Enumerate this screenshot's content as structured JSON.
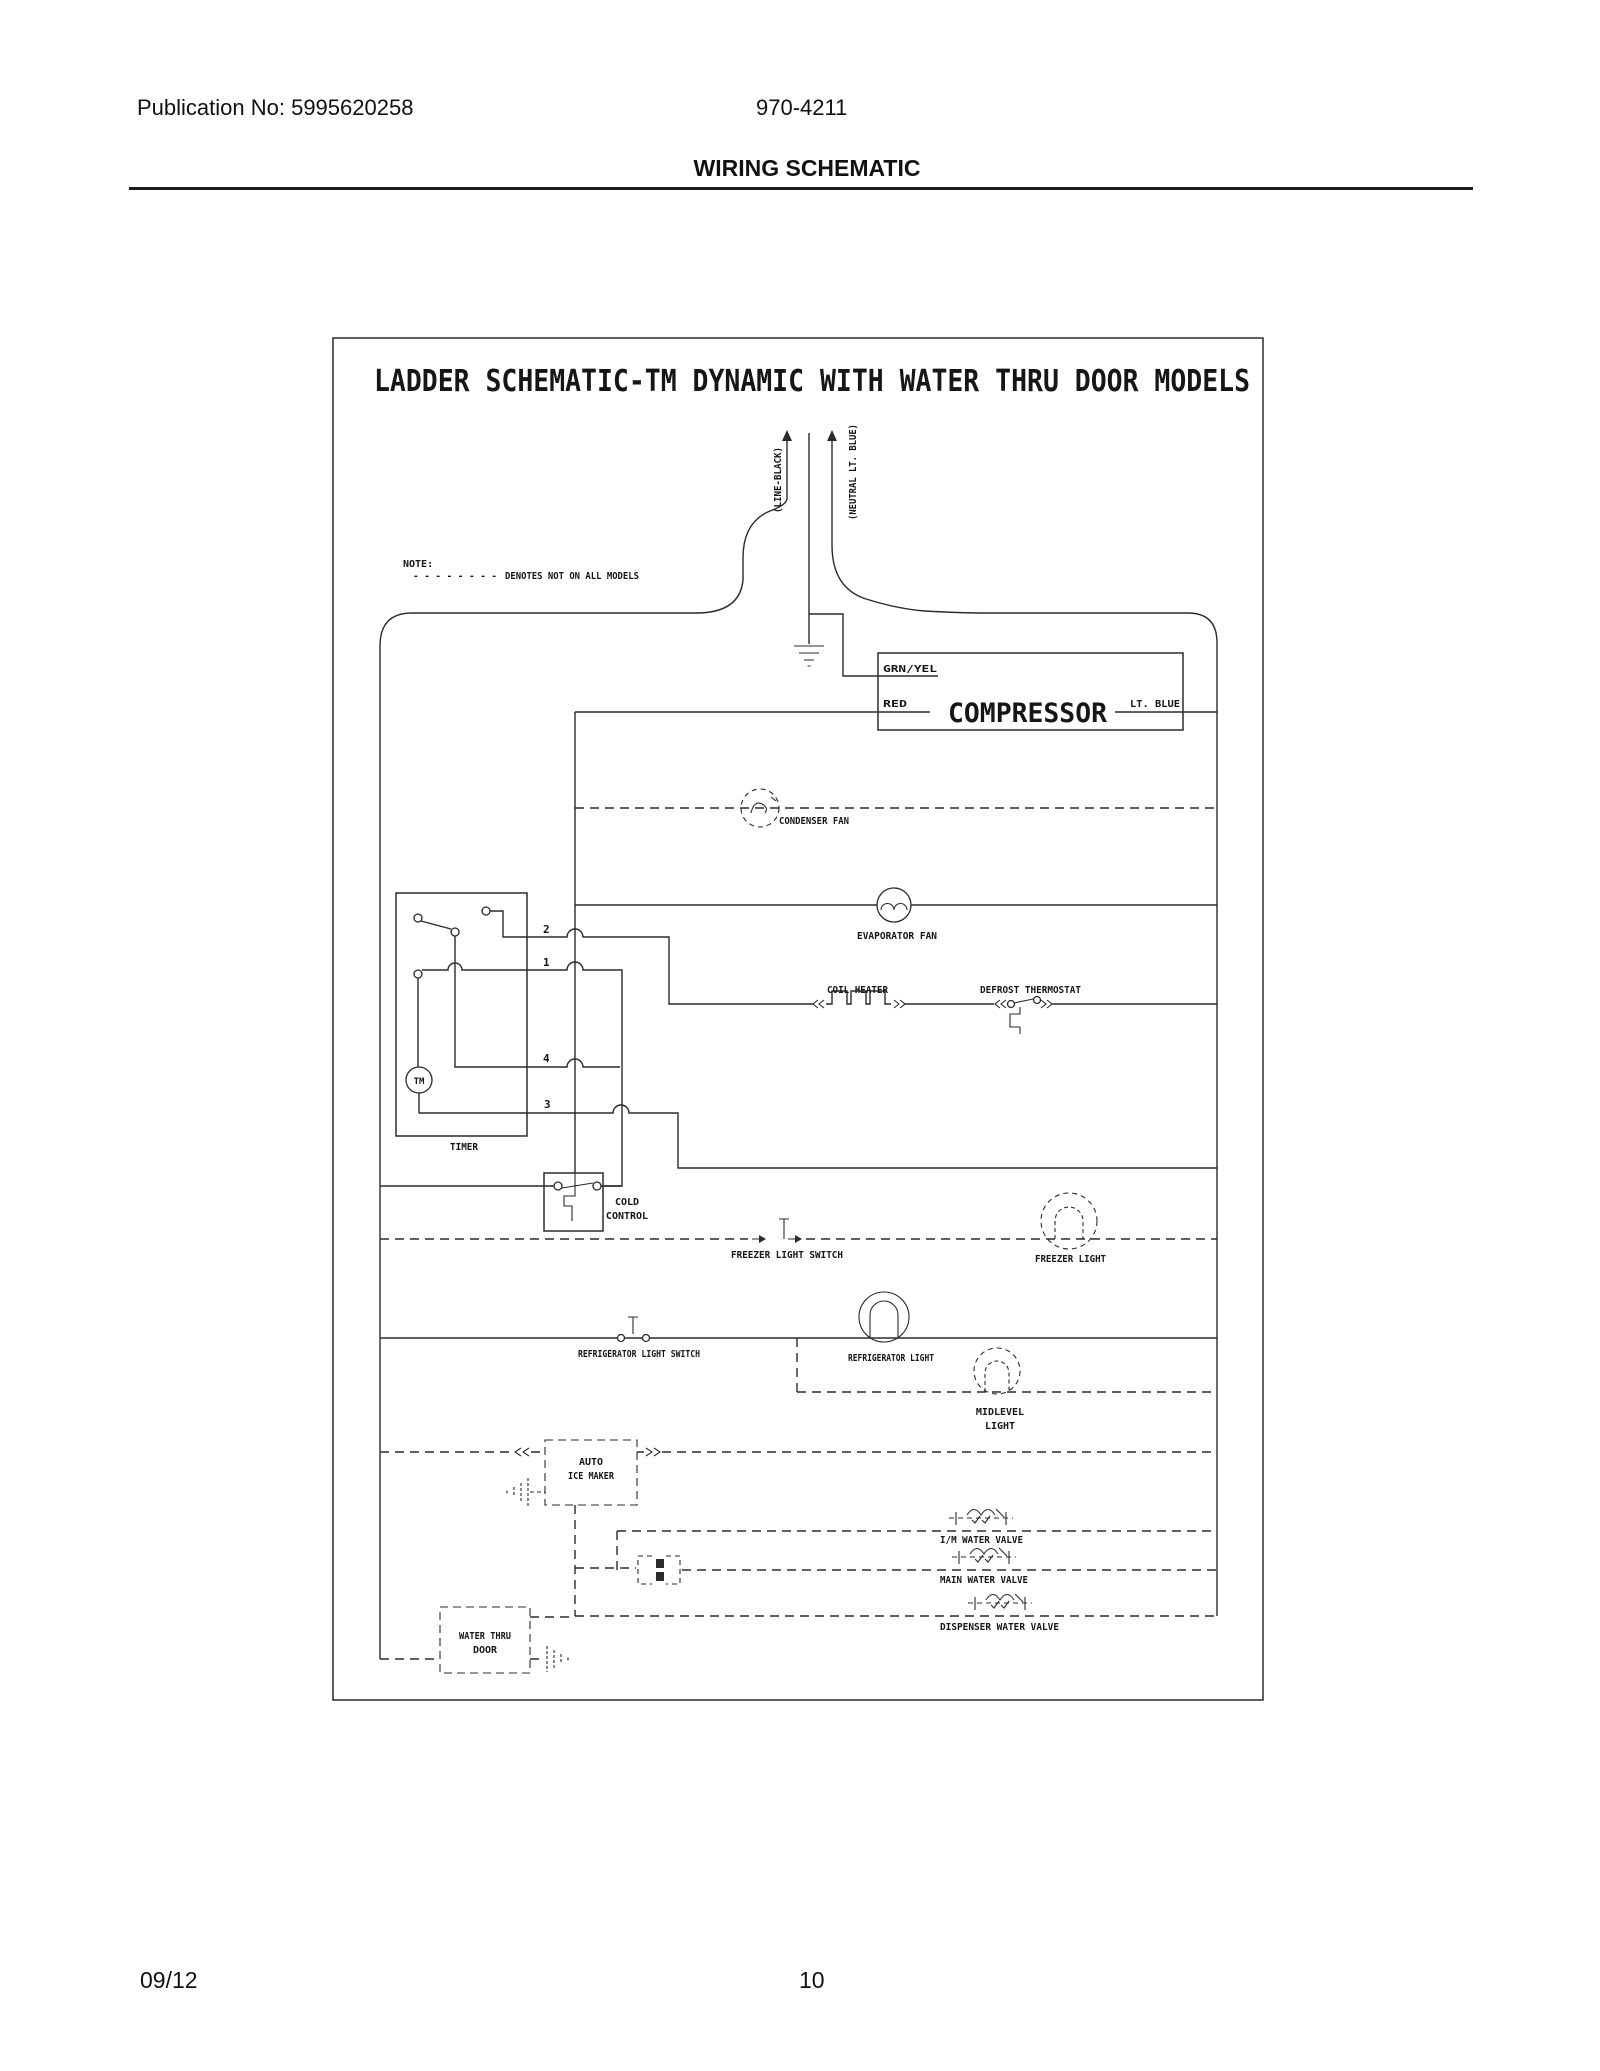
{
  "header": {
    "publication": "Publication No: 5995620258",
    "doc_number": "970-4211",
    "title": "WIRING SCHEMATIC"
  },
  "footer": {
    "date": "09/12",
    "page": "10"
  },
  "schematic": {
    "title": "LADDER SCHEMATIC-TM DYNAMIC WITH WATER THRU DOOR MODELS",
    "note": {
      "label": "NOTE:",
      "dashes": "- - - - - - - -",
      "text": "DENOTES NOT ON ALL MODELS"
    },
    "supply": {
      "line": "(LINE-BLACK)",
      "neutral": "(NEUTRAL LT. BLUE)"
    },
    "compressor": {
      "name": "COMPRESSOR",
      "ground_wire": "GRN/YEL",
      "line_wire": "RED",
      "neutral_wire": "LT. BLUE"
    },
    "condenser_fan": "CONDENSER FAN",
    "evaporator_fan": "EVAPORATOR FAN",
    "coil_heater": "COIL HEATER",
    "defrost_thermostat": "DEFROST THERMOSTAT",
    "timer": {
      "label": "TIMER",
      "motor": "TM",
      "terminal_2": "2",
      "terminal_1": "1",
      "terminal_4": "4",
      "terminal_3": "3"
    },
    "cold_control": {
      "line1": "COLD",
      "line2": "CONTROL"
    },
    "freezer_light_switch": "FREEZER LIGHT SWITCH",
    "freezer_light": "FREEZER LIGHT",
    "refrigerator_light_switch": "REFRIGERATOR LIGHT SWITCH",
    "refrigerator_light": "REFRIGERATOR LIGHT",
    "midlevel_light": {
      "line1": "MIDLEVEL",
      "line2": "LIGHT"
    },
    "auto_ice_maker": {
      "line1": "AUTO",
      "line2": "ICE MAKER"
    },
    "im_water_valve": "I/M WATER VALVE",
    "main_water_valve": "MAIN WATER VALVE",
    "dispenser_water_valve": "DISPENSER WATER VALVE",
    "water_thru_door": {
      "line1": "WATER THRU",
      "line2": "DOOR"
    }
  }
}
